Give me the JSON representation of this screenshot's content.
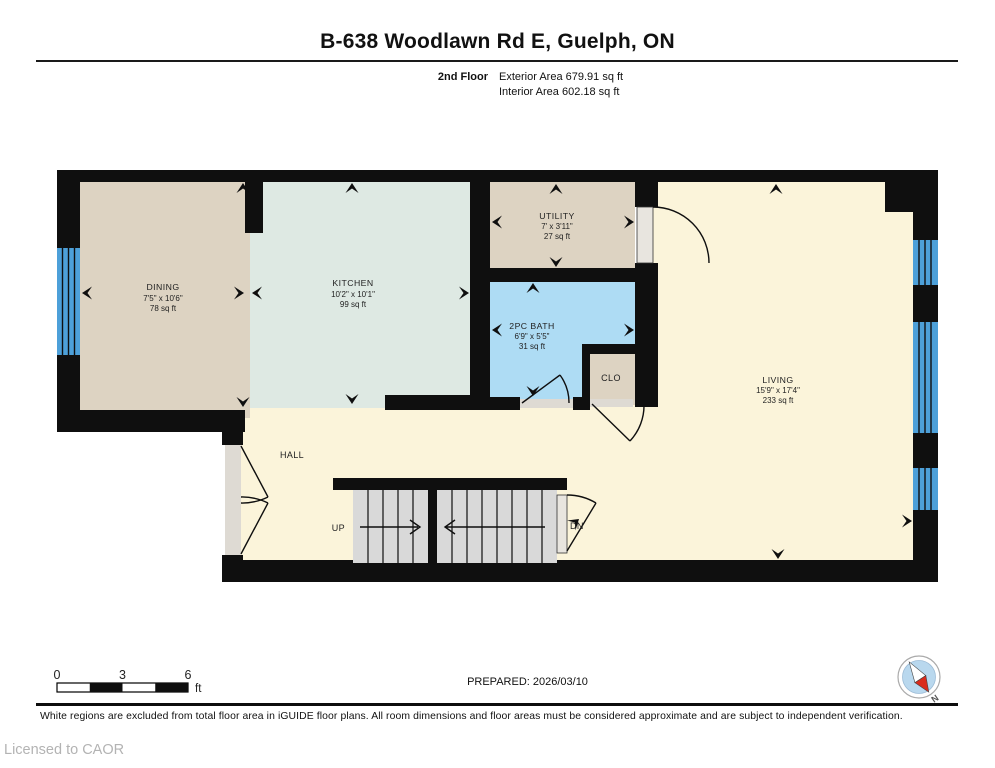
{
  "header": {
    "title": "B-638 Woodlawn Rd E, Guelph, ON",
    "floor_label": "2nd Floor",
    "exterior_area": "Exterior Area 679.91 sq ft",
    "interior_area": "Interior Area 602.18 sq ft"
  },
  "rooms": {
    "dining": {
      "name": "DINING",
      "dims": "7'5\" x 10'6\"",
      "area": "78 sq ft"
    },
    "kitchen": {
      "name": "KITCHEN",
      "dims": "10'2\" x 10'1\"",
      "area": "99 sq ft"
    },
    "utility": {
      "name": "UTILITY",
      "dims": "7' x 3'11\"",
      "area": "27 sq ft"
    },
    "bath": {
      "name": "2PC BATH",
      "dims": "6'9\" x 5'5\"",
      "area": "31 sq ft"
    },
    "closet": {
      "name": "CLO"
    },
    "living": {
      "name": "LIVING",
      "dims": "15'9\" x 17'4\"",
      "area": "233 sq ft"
    },
    "hall": {
      "name": "HALL"
    }
  },
  "stairs": {
    "up_label": "UP",
    "down_label": "DN"
  },
  "scale_bar": {
    "tick0": "0",
    "tick3": "3",
    "tick6": "6",
    "unit": "ft"
  },
  "footer": {
    "prepared": "PREPARED: 2026/03/10",
    "disclaimer": "White regions are excluded from total floor area in iGUIDE floor plans. All room dimensions and floor areas must be considered approximate and are subject to independent verification.",
    "license": "Licensed to CAOR",
    "compass_north": "N"
  },
  "colors": {
    "wall": "#0f0f0f",
    "room_tan": "#ddd3c2",
    "room_mint": "#dee9e3",
    "room_blue": "#aedcf4",
    "room_cream": "#fbf4da",
    "window_blue": "#4da0d9",
    "stair_gray": "#d9d9d9",
    "door_gray": "#e8e5df",
    "threshold_gray": "#dedad3",
    "compass_blue": "#b9d8ee",
    "compass_red": "#d92b1c"
  }
}
